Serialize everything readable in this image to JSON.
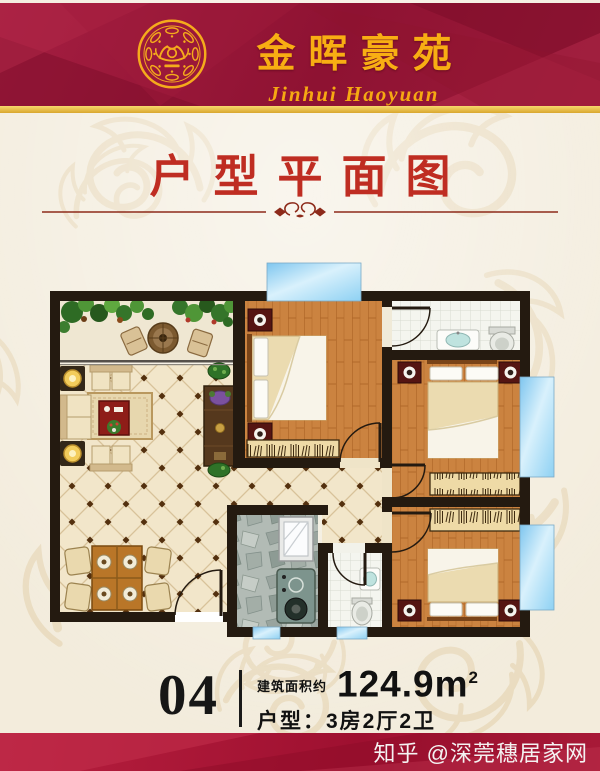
{
  "header": {
    "logo_icon": "gold-filigree-emblem",
    "title": "金晖豪苑",
    "subtitle": "Jinhui Haoyuan"
  },
  "section": {
    "title": "户型平面图"
  },
  "unit_info": {
    "unit_number": "04",
    "area_label": "建筑面积约",
    "area_value": "124.9m",
    "area_sup": "2",
    "layout_label": "户型：",
    "layout_value": "3房2厅2卫"
  },
  "watermark": {
    "text": "知乎 @深莞穗居家网"
  },
  "colors": {
    "banner_red": "#9a1536",
    "gold": "#f5ab1c",
    "title_red": "#bf2d22",
    "page_cream": "#f3ecdc",
    "wall_black": "#241a10",
    "wood_floor": "#cb8340",
    "tile_cream": "#f2e6ca",
    "kitchen_stone": "#b2bbb5",
    "window_blue": "#a8dcf5",
    "footer_red": "#ab1535"
  },
  "floorplan": {
    "type": "apartment-floor-plan",
    "doors_count": 6,
    "windows_count": 5,
    "rooms": [
      {
        "name": "balcony",
        "floor": "cream-tile",
        "features": [
          "garden-plants",
          "patio-table",
          "two-cushion-seats"
        ]
      },
      {
        "name": "living-room",
        "floor": "diamond-tile",
        "features": [
          "sofa-set",
          "floor-lamps",
          "rug",
          "coffee-table",
          "tv-cabinet",
          "potted-plants"
        ]
      },
      {
        "name": "dining-area",
        "floor": "diamond-tile",
        "features": [
          "dining-table-for-four"
        ]
      },
      {
        "name": "bedroom-1",
        "floor": "wood-plank",
        "features": [
          "double-bed",
          "two-nightstands",
          "wardrobe",
          "window"
        ]
      },
      {
        "name": "master-bedroom",
        "floor": "wood-plank",
        "features": [
          "double-bed",
          "two-nightstands",
          "wardrobe",
          "bay-window"
        ]
      },
      {
        "name": "bedroom-3",
        "floor": "wood-plank",
        "features": [
          "double-bed",
          "two-nightstands",
          "wardrobe",
          "bay-window"
        ]
      },
      {
        "name": "bathroom-1",
        "floor": "white-tile",
        "features": [
          "sink",
          "toilet"
        ]
      },
      {
        "name": "bathroom-2",
        "floor": "white-tile",
        "features": [
          "sink",
          "toilet",
          "window"
        ]
      },
      {
        "name": "kitchen",
        "floor": "grey-stone",
        "features": [
          "glass-unit",
          "stove-water-heater",
          "window"
        ]
      },
      {
        "name": "hallway",
        "floor": "diamond-tile",
        "features": []
      }
    ]
  }
}
